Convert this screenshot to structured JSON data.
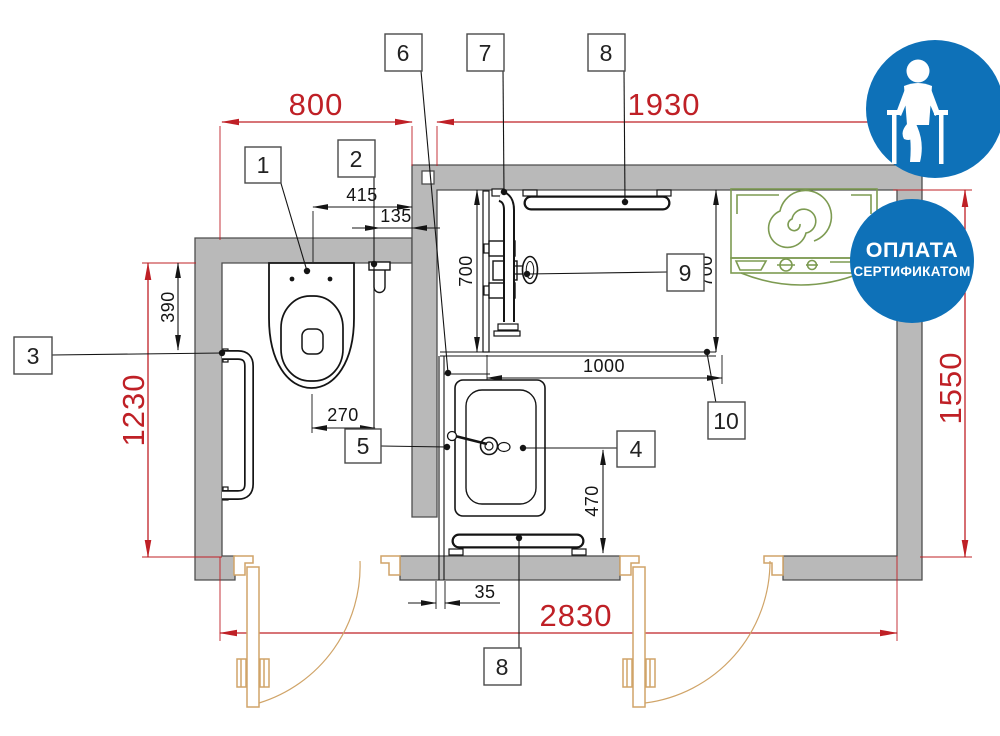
{
  "plan": {
    "title": "accessible-bathroom-floor-plan",
    "dims": {
      "w_toilet_room": "800",
      "w_shower_room": "1930",
      "h_toilet_room": "1230",
      "h_shower_room": "1550",
      "w_total": "2830",
      "toilet_axis": "415",
      "niche": "135",
      "bar_offset": "390",
      "toilet_to_holder": "270",
      "shower_depth_l": "700",
      "shower_depth_r": "700",
      "shower_width": "1000",
      "sink_clearance": "470",
      "gap": "35"
    },
    "callouts": {
      "c1": "1",
      "c2": "2",
      "c3": "3",
      "c4": "4",
      "c5": "5",
      "c6": "6",
      "c7": "7",
      "c8_top": "8",
      "c8_bottom": "8",
      "c9": "9",
      "c10": "10"
    },
    "badges": {
      "payment_title": "ОПЛАТА",
      "payment_subtitle": "СЕРТИФИКАТОМ",
      "accessibility_icon": "person-on-crutches-icon"
    },
    "colors": {
      "dimension_red": "#bf2026",
      "wall_gray": "#b9b9b9",
      "line_black": "#141414",
      "door_tan": "#d0a468",
      "appliance_green": "#7d9b52",
      "badge_blue": "#0e71b8"
    }
  }
}
